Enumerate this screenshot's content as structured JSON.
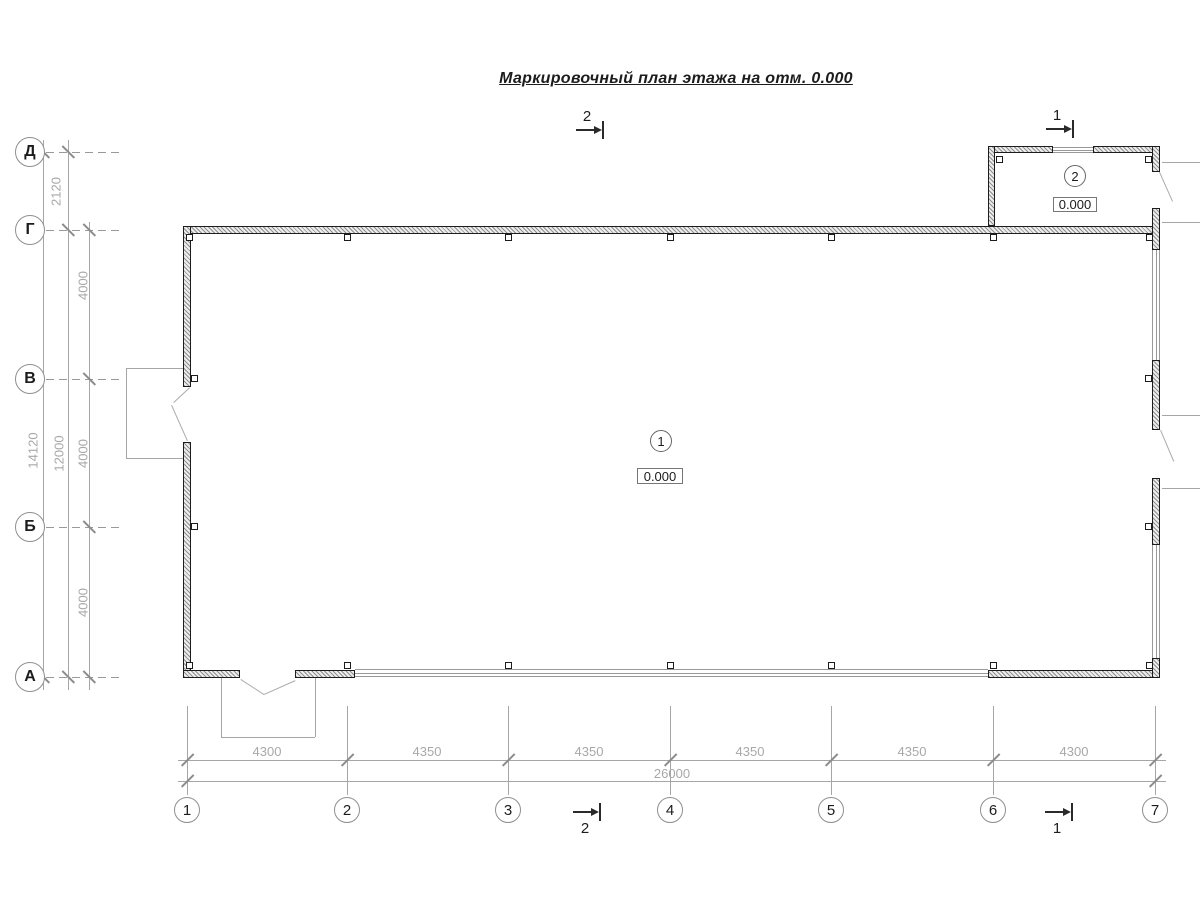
{
  "title": "Маркировочный план этажа на отм. 0.000",
  "axes": {
    "vertical": [
      "Д",
      "Г",
      "В",
      "Б",
      "А"
    ],
    "horizontal": [
      "1",
      "2",
      "3",
      "4",
      "5",
      "6",
      "7"
    ]
  },
  "dimensions": {
    "left": {
      "top_segment": "2120",
      "segments": [
        "4000",
        "4000",
        "4000"
      ],
      "subtotal": "12000",
      "total": "14120"
    },
    "bottom": {
      "segments": [
        "4300",
        "4350",
        "4350",
        "4350",
        "4350",
        "4300"
      ],
      "total": "26000"
    }
  },
  "sections": [
    {
      "label": "2"
    },
    {
      "label": "1"
    }
  ],
  "rooms": [
    {
      "number": "1",
      "elevation": "0.000"
    },
    {
      "number": "2",
      "elevation": "0.000"
    }
  ],
  "colors": {
    "wall_outline": "#1c1c1c",
    "dim_text_gray": "#a8a8a8",
    "line_gray": "#999999"
  }
}
